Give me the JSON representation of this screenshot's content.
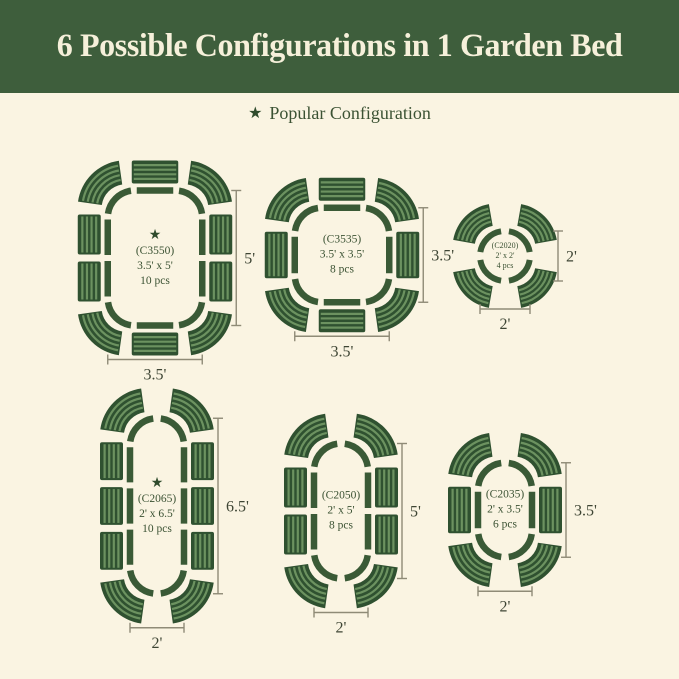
{
  "header": {
    "title": "6 Possible Configurations in 1 Garden Bed"
  },
  "legend": {
    "label": "Popular Configuration"
  },
  "icons": {
    "star": "★"
  },
  "colors": {
    "background": "#faf4e2",
    "banner": "#3e5e3c",
    "banner_text": "#f6f0da",
    "panel": "#2f5130",
    "panel_stripe": "#6c9260",
    "outline": "#3a5a36",
    "label_text": "#3b5233",
    "star": "#2f4b2c",
    "dim_line": "#8f8b77",
    "dim_text": "#3e4534"
  },
  "configurations": [
    {
      "code": "(C3550)",
      "size": "3.5' x 5'",
      "pieces": "10 pcs",
      "popular": true,
      "shape": "rect",
      "feet": [
        3.5,
        5
      ],
      "panels": {
        "top": 1,
        "right": 2,
        "bottom": 1,
        "left": 2
      },
      "width_label": "3.5'",
      "height_label": "5'"
    },
    {
      "code": "(C3535)",
      "size": "3.5' x 3.5'",
      "pieces": "8 pcs",
      "popular": false,
      "shape": "rect",
      "feet": [
        3.5,
        3.5
      ],
      "panels": {
        "top": 1,
        "right": 1,
        "bottom": 1,
        "left": 1
      },
      "width_label": "3.5'",
      "height_label": "3.5'"
    },
    {
      "code": "(C2020)",
      "size": "2' x 2'",
      "pieces": "4 pcs",
      "popular": false,
      "shape": "circle",
      "feet": [
        2,
        2
      ],
      "panels": {},
      "width_label": "2'",
      "height_label": "2'"
    },
    {
      "code": "(C2065)",
      "size": "2' x 6.5'",
      "pieces": "10 pcs",
      "popular": true,
      "shape": "pill",
      "feet": [
        2,
        6.5
      ],
      "panels": {
        "left": 3,
        "right": 3
      },
      "width_label": "2'",
      "height_label": "6.5'"
    },
    {
      "code": "(C2050)",
      "size": "2' x 5'",
      "pieces": "8 pcs",
      "popular": false,
      "shape": "pill",
      "feet": [
        2,
        5
      ],
      "panels": {
        "left": 2,
        "right": 2
      },
      "width_label": "2'",
      "height_label": "5'"
    },
    {
      "code": "(C2035)",
      "size": "2' x 3.5'",
      "pieces": "6 pcs",
      "popular": false,
      "shape": "pill",
      "feet": [
        2,
        3.5
      ],
      "panels": {
        "left": 1,
        "right": 1
      },
      "width_label": "2'",
      "height_label": "3.5'"
    }
  ]
}
